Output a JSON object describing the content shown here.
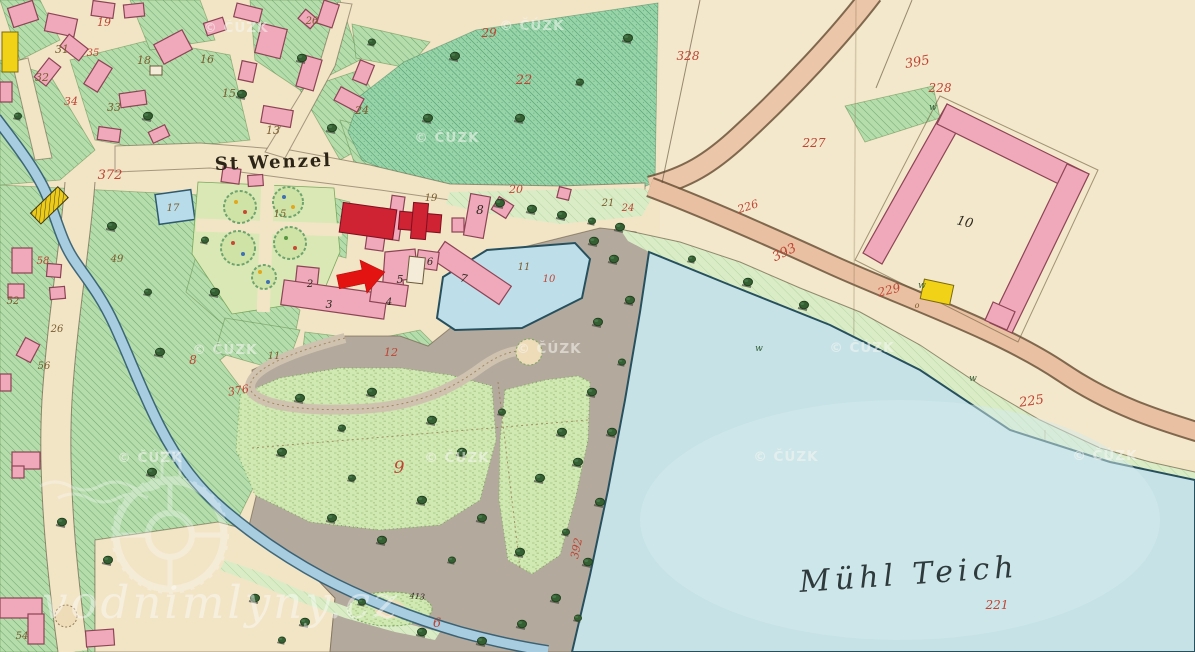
{
  "map": {
    "type": "historical-cadastral-map",
    "place_labels": {
      "settlement": "St Wenzel",
      "pond": "Mühl Teich"
    },
    "colors": {
      "paper": "#f2e5c6",
      "field_green": "#b5dcab",
      "field_teal": "#97d4a8",
      "meadow_light": "#d9ecc6",
      "lawn": "#d0e8b2",
      "park_gray": "#b3a99c",
      "water_pond": "#c6e2e6",
      "water_stream": "#a9cde0",
      "road_salmon": "#ecc6a8",
      "building_pink": "#efa9ba",
      "building_red": "#cf2233",
      "building_yellow": "#f2d216",
      "label_red": "#bf4434",
      "label_brown": "#7a5c2e",
      "label_black": "#2f2a20",
      "label_green": "#2f5d33",
      "arrow_red": "#e21310",
      "watermark_white": "#f7f7f2"
    },
    "parcel_labels": [
      {
        "t": "19",
        "x": 104,
        "y": 26,
        "c": "red",
        "s": 11
      },
      {
        "t": "31",
        "x": 62,
        "y": 53,
        "c": "brown",
        "s": 11
      },
      {
        "t": "35",
        "x": 93,
        "y": 56,
        "c": "red",
        "s": 10
      },
      {
        "t": "32",
        "x": 42,
        "y": 81,
        "c": "brown",
        "s": 11
      },
      {
        "t": "34",
        "x": 71,
        "y": 105,
        "c": "red",
        "s": 11
      },
      {
        "t": "33",
        "x": 114,
        "y": 111,
        "c": "brown",
        "s": 11
      },
      {
        "t": "18",
        "x": 144,
        "y": 64,
        "c": "brown",
        "s": 11
      },
      {
        "t": "16",
        "x": 207,
        "y": 63,
        "c": "brown",
        "s": 11
      },
      {
        "t": "15",
        "x": 229,
        "y": 97,
        "c": "brown",
        "s": 11
      },
      {
        "t": "13",
        "x": 273,
        "y": 134,
        "c": "brown",
        "s": 11
      },
      {
        "t": "372",
        "x": 110,
        "y": 179,
        "c": "red",
        "s": 13
      },
      {
        "t": "17",
        "x": 173,
        "y": 211,
        "c": "brown",
        "s": 10
      },
      {
        "t": "15",
        "x": 280,
        "y": 217,
        "c": "brown",
        "s": 10
      },
      {
        "t": "26",
        "x": 312,
        "y": 24,
        "c": "brown",
        "s": 10
      },
      {
        "t": "24",
        "x": 362,
        "y": 114,
        "c": "brown",
        "s": 11
      },
      {
        "t": "29",
        "x": 489,
        "y": 37,
        "c": "red",
        "s": 12
      },
      {
        "t": "22",
        "x": 524,
        "y": 84,
        "c": "red",
        "s": 13
      },
      {
        "t": "328",
        "x": 688,
        "y": 60,
        "c": "red",
        "s": 12
      },
      {
        "t": "395",
        "x": 918,
        "y": 66,
        "c": "red",
        "s": 13,
        "r": -10
      },
      {
        "t": "228",
        "x": 940,
        "y": 92,
        "c": "red",
        "s": 12
      },
      {
        "t": "227",
        "x": 814,
        "y": 147,
        "c": "red",
        "s": 12
      },
      {
        "t": "226",
        "x": 749,
        "y": 210,
        "c": "red",
        "s": 11,
        "r": -18
      },
      {
        "t": "393",
        "x": 786,
        "y": 256,
        "c": "red",
        "s": 13,
        "r": -26
      },
      {
        "t": "229",
        "x": 890,
        "y": 294,
        "c": "red",
        "s": 12,
        "r": -14
      },
      {
        "t": "10",
        "x": 964,
        "y": 226,
        "c": "black",
        "s": 13,
        "r": 14
      },
      {
        "t": "o",
        "x": 917,
        "y": 308,
        "c": "brown",
        "s": 8
      },
      {
        "t": "225",
        "x": 1032,
        "y": 405,
        "c": "red",
        "s": 13,
        "r": -8
      },
      {
        "t": "221",
        "x": 997,
        "y": 609,
        "c": "red",
        "s": 12
      },
      {
        "t": "20",
        "x": 516,
        "y": 193,
        "c": "red",
        "s": 11
      },
      {
        "t": "19",
        "x": 431,
        "y": 201,
        "c": "brown",
        "s": 10
      },
      {
        "t": "21",
        "x": 608,
        "y": 206,
        "c": "brown",
        "s": 10
      },
      {
        "t": "24",
        "x": 628,
        "y": 211,
        "c": "red",
        "s": 10
      },
      {
        "t": "8",
        "x": 480,
        "y": 214,
        "c": "black",
        "s": 12
      },
      {
        "t": "7",
        "x": 463,
        "y": 282,
        "c": "black",
        "s": 11,
        "r": 12
      },
      {
        "t": "6",
        "x": 430,
        "y": 265,
        "c": "black",
        "s": 10
      },
      {
        "t": "5",
        "x": 400,
        "y": 283,
        "c": "black",
        "s": 11
      },
      {
        "t": "4",
        "x": 389,
        "y": 305,
        "c": "black",
        "s": 10
      },
      {
        "t": "3",
        "x": 329,
        "y": 308,
        "c": "black",
        "s": 11
      },
      {
        "t": "2",
        "x": 310,
        "y": 287,
        "c": "black",
        "s": 10
      },
      {
        "t": "11",
        "x": 524,
        "y": 270,
        "c": "brown",
        "s": 10
      },
      {
        "t": "10",
        "x": 549,
        "y": 282,
        "c": "red",
        "s": 10
      },
      {
        "t": "11",
        "x": 274,
        "y": 359,
        "c": "brown",
        "s": 10
      },
      {
        "t": "12",
        "x": 391,
        "y": 356,
        "c": "red",
        "s": 11
      },
      {
        "t": "9",
        "x": 399,
        "y": 473,
        "c": "red",
        "s": 17
      },
      {
        "t": "376",
        "x": 239,
        "y": 394,
        "c": "red",
        "s": 11,
        "r": -10
      },
      {
        "t": "8",
        "x": 193,
        "y": 364,
        "c": "red",
        "s": 12
      },
      {
        "t": "6",
        "x": 437,
        "y": 627,
        "c": "red",
        "s": 13
      },
      {
        "t": "413",
        "x": 417,
        "y": 599,
        "c": "black",
        "s": 8,
        "r": 6
      },
      {
        "t": "392",
        "x": 580,
        "y": 549,
        "c": "red",
        "s": 11,
        "r": -78
      },
      {
        "t": "58",
        "x": 43,
        "y": 264,
        "c": "red",
        "s": 10
      },
      {
        "t": "49",
        "x": 117,
        "y": 262,
        "c": "brown",
        "s": 10
      },
      {
        "t": "52",
        "x": 13,
        "y": 304,
        "c": "brown",
        "s": 10
      },
      {
        "t": "56",
        "x": 44,
        "y": 369,
        "c": "brown",
        "s": 10
      },
      {
        "t": "26",
        "x": 57,
        "y": 332,
        "c": "brown",
        "s": 10
      },
      {
        "t": "54",
        "x": 22,
        "y": 639,
        "c": "brown",
        "s": 10
      },
      {
        "t": "w",
        "x": 933,
        "y": 110,
        "c": "green",
        "s": 9
      },
      {
        "t": "w",
        "x": 922,
        "y": 288,
        "c": "green",
        "s": 9
      },
      {
        "t": "w",
        "x": 973,
        "y": 381,
        "c": "green",
        "s": 9
      },
      {
        "t": "w",
        "x": 759,
        "y": 351,
        "c": "green",
        "s": 9
      }
    ]
  },
  "watermarks": {
    "copyright": {
      "text": "© ČÚZK",
      "positions": [
        [
          236,
          32
        ],
        [
          532,
          30
        ],
        [
          447,
          142
        ],
        [
          225,
          354
        ],
        [
          549,
          353
        ],
        [
          862,
          352
        ],
        [
          150,
          462
        ],
        [
          457,
          462
        ],
        [
          786,
          461
        ],
        [
          1105,
          460
        ]
      ]
    },
    "site": {
      "text": "vodnimlyny.cz"
    }
  },
  "annotations": {
    "target_arrow": {
      "shape": "right-pointing-arrow",
      "color": "#e21310"
    }
  }
}
